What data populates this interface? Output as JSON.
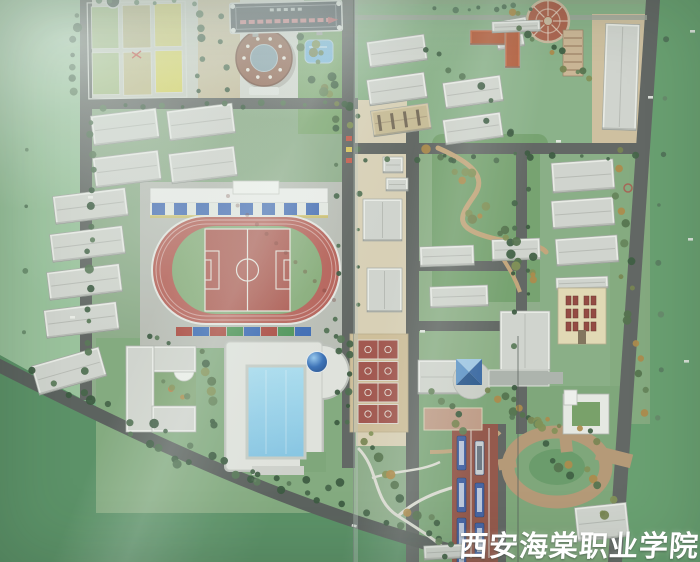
{
  "photo": {
    "subject": "Aerial photograph of a campus master-plan architectural scale model displayed behind glass",
    "watermark_text": "西安海棠职业学院"
  },
  "features": [
    "field-plots",
    "name-plaque",
    "round-gymnasium",
    "garden-pond",
    "grandstand",
    "running-track",
    "football-field",
    "dormitory-rows",
    "apartment-blocks",
    "orange-roof-building",
    "circular-plaza",
    "natatorium",
    "swimming-pool",
    "blue-dome",
    "l-shaped-building",
    "basketball-courts",
    "pyramid-skylight-hall",
    "covered-walkway",
    "red-window-facade-building",
    "ring-road",
    "bus-parking",
    "winding-garden-paths",
    "boundary-roads",
    "glass-reflections"
  ],
  "colors": {
    "base_lawn": "#6da77a",
    "dark_lawn": "#4f8a5c",
    "pavement": "#b6bab2",
    "plaza_tan": "#d9cfb3",
    "road": "#565b58",
    "track_red": "#b2564d",
    "pitch_red": "#a84e45",
    "infield_green": "#7fa771",
    "pool_blue": "#8ecfe9",
    "dome_blue": "#2a66b4",
    "court_red": "#9c4a42",
    "bus_blue": "#38589f",
    "bus_lot_red": "#8d4b3e",
    "building_white": "#eaece7",
    "roof_gray": "#d0d3cd",
    "orange_roof": "#c2623c",
    "tree_green": "#37583b",
    "watermark_white": "#ffffff"
  }
}
